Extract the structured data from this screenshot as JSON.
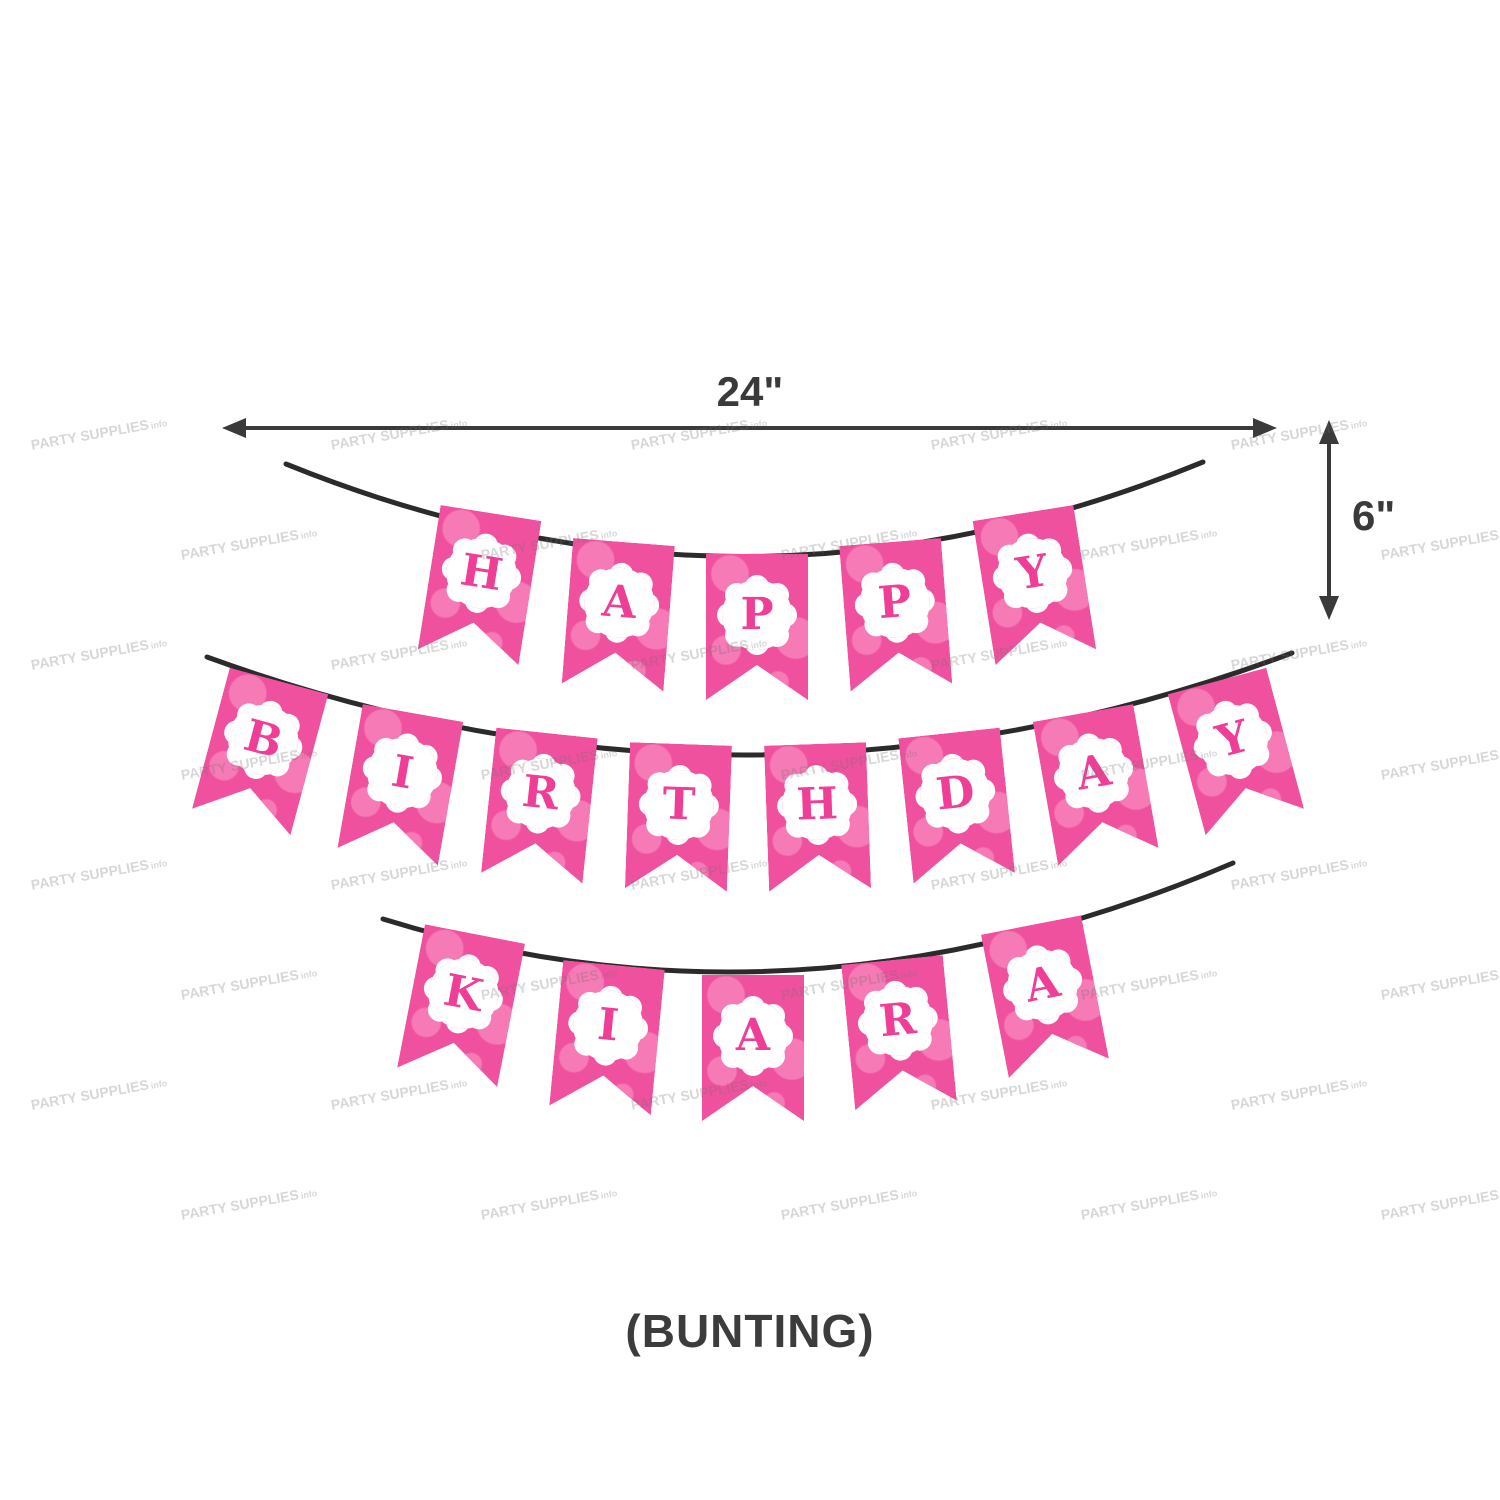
{
  "dimensions": {
    "width_label": "24\"",
    "height_label": "6\""
  },
  "caption": {
    "text": "(BUNTING)"
  },
  "banner": {
    "rows": [
      {
        "word": "HAPPY",
        "letters": [
          "H",
          "A",
          "P",
          "P",
          "Y"
        ]
      },
      {
        "word": "BIRTHDAY",
        "letters": [
          "B",
          "I",
          "R",
          "T",
          "H",
          "D",
          "A",
          "Y"
        ]
      },
      {
        "word": "KIARA",
        "letters": [
          "K",
          "I",
          "A",
          "R",
          "A"
        ]
      }
    ],
    "flag_color": "#f0519f",
    "flag_pattern_color": "#f67ab5",
    "letter_color": "#ee3e95",
    "badge_color": "#ffffff",
    "string_color": "#2b2b2b"
  },
  "watermark": {
    "text": "PARTY SUPPLIES",
    "suffix": "info"
  },
  "arrow_color": "#3a3a3a"
}
